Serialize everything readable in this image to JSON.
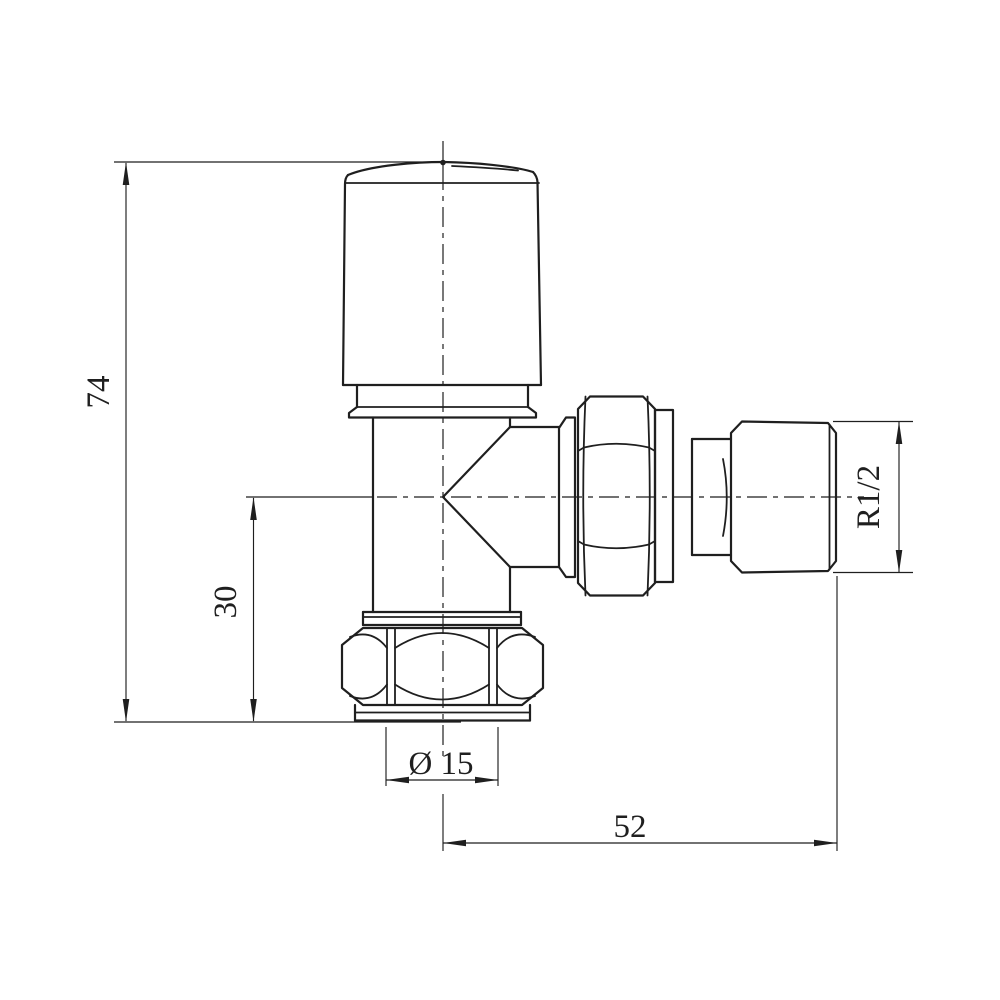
{
  "drawing": {
    "background_color": "#ffffff",
    "line_color": "#1f1f1f",
    "labels": {
      "overall_height": "74",
      "center_to_base": "30",
      "pipe_diameter": "Ø 15",
      "overall_length": "52",
      "thread_size": "R1/2"
    }
  }
}
